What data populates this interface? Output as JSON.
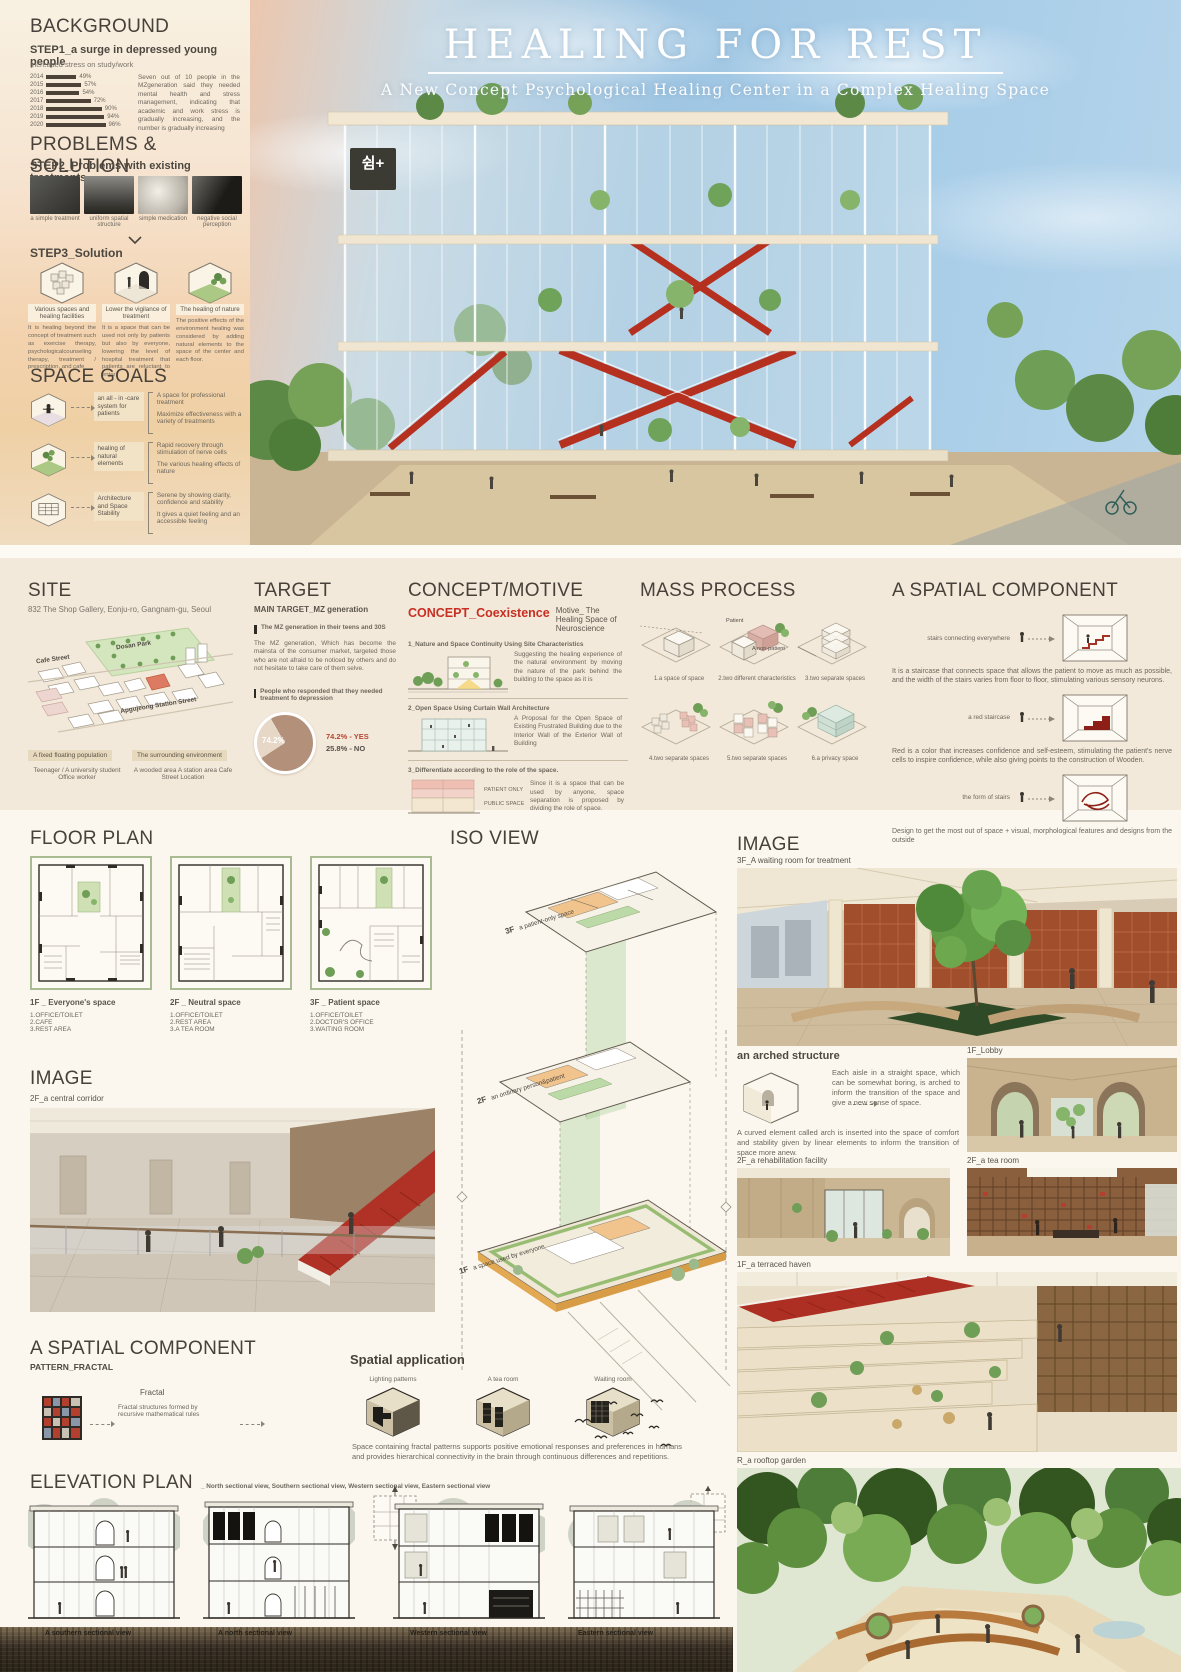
{
  "hero": {
    "title": "HEALING FOR REST",
    "subtitle": "A New Concept Psychological Healing Center in a Complex Healing Space",
    "sign": "쉼+"
  },
  "sidebar": {
    "background": {
      "heading": "BACKGROUND",
      "step_title": "STEP1_a surge in depressed young people",
      "step_sub": "Increased stress on study/work",
      "chart": {
        "type": "bar",
        "rows": [
          {
            "year": "2014",
            "value": 49,
            "label": "49%"
          },
          {
            "year": "2015",
            "value": 57,
            "label": "57%"
          },
          {
            "year": "2016",
            "value": 54,
            "label": "54%"
          },
          {
            "year": "2017",
            "value": 72,
            "label": "72%"
          },
          {
            "year": "2018",
            "value": 90,
            "label": "90%"
          },
          {
            "year": "2019",
            "value": 94,
            "label": "94%"
          },
          {
            "year": "2020",
            "value": 96,
            "label": "96%"
          }
        ]
      },
      "paragraph": "Seven out of 10 people in the MZgeneration said they needed mental health and stress management, indicating that academic and work stress is gradually increasing, and the number is gradually increasing"
    },
    "problems": {
      "heading": "PROBLEMS & SOLUTION",
      "step_title": "STEP2_Problems with existing treatments",
      "items": [
        "a simple treatment",
        "uniform spatial structure",
        "simple medication",
        "negative social perception"
      ]
    },
    "solution": {
      "step_title": "STEP3_Solution",
      "items": [
        {
          "title": "Various spaces and healing facilities",
          "text": "It is healing beyond the concept of treatment such as exercise therapy, psychologicalcounseling therapy, treatment / prescription, and cafe"
        },
        {
          "title": "Lower the vigilance of treatment",
          "text": "It is a space that can be used not only by patients but also by everyone, lowering the level of hospital treatment that patients are reluctant to enter"
        },
        {
          "title": "The healing of nature",
          "text": "The positive effects of the environment healing was considered by adding natural elements to the space of the center and each floor."
        }
      ]
    },
    "space_goals": {
      "heading": "SPACE GOALS",
      "items": [
        {
          "label": "an all - in -care system for patients",
          "points": [
            "A space for professional treatment",
            "Maximize effectiveness with a variety of treatments"
          ]
        },
        {
          "label": "healing of natural elements",
          "points": [
            "Rapid recovery through stimulation of nerve cells",
            "The various healing effects of nature"
          ]
        },
        {
          "label": "Architecture and Space Stability",
          "points": [
            "Serene by showing clarity, confidence and stability",
            "It gives a quiet feeling and an accessible feeling"
          ]
        }
      ]
    }
  },
  "site": {
    "heading": "SITE",
    "address": "832 The Shop Gallery, Eonju-ro, Gangnam-gu, Seoul",
    "map_labels": {
      "park": "Dosan Park",
      "cafe": "Cafe Street",
      "station": "Apgujeong Station Street"
    },
    "tags": [
      {
        "tag": "A fixed floating population",
        "detail": "Teenager / A university student Office worker"
      },
      {
        "tag": "The surrounding environment",
        "detail": "A wooded area A station area Cafe Street Location"
      }
    ]
  },
  "target": {
    "heading": "TARGET",
    "subheading": "MAIN TARGET_MZ generation",
    "bullet1": "The MZ generation in their teens and 30S",
    "paragraph": "The MZ generation, Which has become the mainsta of the consumer market, targeted those who are not afraid to be noticed by others and do not hesitate to take care of them selve.",
    "bullet2": "People who responded that they needed treatment fo depression",
    "pie": {
      "type": "pie",
      "yes_pct": 74.2,
      "center_label": "74.2%",
      "legend_yes": "74.2% - YES",
      "legend_no": "25.8% - NO"
    }
  },
  "concept": {
    "heading": "CONCEPT/MOTIVE",
    "concept_label": "CONCEPT_Coexistence",
    "motive_label": "Motive_ The Healing Space of Neuroscience",
    "items": [
      {
        "title": "1_Nature and Space Continuity Using Site Characteristics",
        "text": "Suggesting the healing experience of the natural environment by moving the nature of the park behind the building to the space as it is"
      },
      {
        "title": "2_Open Space Using Curtain Wall Architecture",
        "text": "A Proposal for the Open Space of Existing Frustrated Building due to the Interior Wall of the Exterior Wall of Building"
      },
      {
        "title": "3_Differentiate according to the role of the space.",
        "text": "Since it is a space that can be used by anyone, space separation is proposed by dividing the role of space.",
        "label_top": "PATIENT ONLY",
        "label_bottom": "PUBLIC SPACE"
      }
    ]
  },
  "mass": {
    "heading": "MASS PROCESS",
    "steps": [
      {
        "caption": "1.a space of space"
      },
      {
        "caption": "2.two different characteristics",
        "label_a": "Patient",
        "label_b": "A non-patient"
      },
      {
        "caption": "3.two separate spaces"
      },
      {
        "caption": "4.two separate spaces"
      },
      {
        "caption": "5.two separate spaces"
      },
      {
        "caption": "6.a privacy space"
      }
    ]
  },
  "spatial": {
    "heading": "A SPATIAL COMPONENT",
    "rows": [
      {
        "label": "stairs connecting everywhere",
        "text": "It is a staircase that connects space that allows the patient to move as much as possible, and the width of the stairs varies from floor to floor, stimulating various sensory neurons."
      },
      {
        "label": "a red staircase",
        "text": "Red is a color that increases confidence and self-esteem, stimulating the patient's nerve cells to inspire confidence, while also giving points to the construction of Wooden."
      },
      {
        "label": "the form of stairs",
        "text": "Design to get the most out of space + visual, morphological features and designs from the outside"
      }
    ]
  },
  "floor_plan": {
    "heading": "FLOOR PLAN",
    "plans": [
      {
        "name": "1F _ Everyone's space",
        "rooms": [
          "1.OFFICE/TOILET",
          "2.CAFE",
          "3.REST AREA"
        ]
      },
      {
        "name": "2F _ Neutral space",
        "rooms": [
          "1.OFFICE/TOILET",
          "2.REST AREA",
          "3.A TEA ROOM"
        ]
      },
      {
        "name": "3F _ Patient space",
        "rooms": [
          "1.OFFICE/TOILET",
          "2.DOCTOR'S OFFICE",
          "3.WAITING ROOM"
        ]
      }
    ]
  },
  "image_left": {
    "heading": "IMAGE",
    "caption": "2F_a central corridor"
  },
  "fractal": {
    "heading": "A SPATIAL COMPONENT",
    "subheading": "PATTERN_FRACTAL",
    "label": "Fractal",
    "text": "Fractal structures formed by recursive mathematical rules",
    "application_title": "Spatial application",
    "applications": [
      "Lighting patterns",
      "A tea room",
      "Waiting room"
    ],
    "paragraph": "Space containing fractal patterns supports positive emotional responses and preferences in humans and provides hierarchical connectivity in the brain through continuous differences and repetitions."
  },
  "iso": {
    "heading": "ISO VIEW",
    "floors": [
      {
        "level": "3F",
        "label": "a patient-only space"
      },
      {
        "level": "2F",
        "label": "an ordinary person&patient"
      },
      {
        "level": "1F",
        "label": "a space used by everyone"
      }
    ]
  },
  "image_right": {
    "heading": "IMAGE",
    "waiting_caption": "3F_A waiting room for treatment",
    "arch_title": "an arched structure",
    "arch_text1": "Each aisle in a straight space, which can be somewhat boring, is arched to inform the transition of the space and give a new sense of space.",
    "arch_text2": "A curved element called arch is inserted into the space of comfort and stability given by linear elements to inform the transition of space more anew.",
    "lobby_caption": "1F_Lobby",
    "rehab_caption": "2F_a rehabilitation facility",
    "tea_caption": "2F_a tea room",
    "terrace_caption": "1F_a terraced haven",
    "rooftop_caption": "R_a rooftop garden"
  },
  "elevation": {
    "heading": "ELEVATION PLAN",
    "subheading": "_ North sectional view, Southern sectional view, Western sectional view, Eastern sectional view",
    "captions": [
      "A southern sectional view",
      "A north sectional view",
      "Western sectional view",
      "Eastern sectional view"
    ]
  },
  "colors": {
    "accent_red": "#c0392b",
    "stair_red": "#b03226",
    "band_bg": "#f3e9da",
    "bar_color": "#4d4237",
    "site_red": "#dd7b62",
    "green": "#6f9e57"
  }
}
